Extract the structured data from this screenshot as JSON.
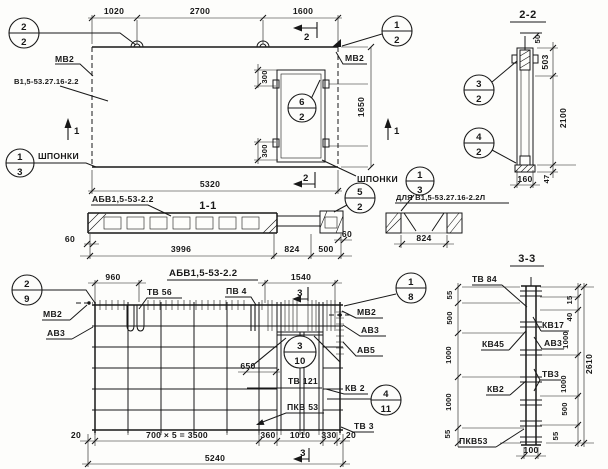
{
  "sheet": {
    "background": "#fdfdfb",
    "ink": "#181818"
  },
  "views": {
    "elevation": {
      "dims": {
        "w1": "1020",
        "w2": "2700",
        "w3": "1600",
        "total": "5320",
        "height": "1650",
        "off_top": "300",
        "off_bottom": "300"
      },
      "labels": {
        "mv2_left": "МВ2",
        "mv2_right": "МВ2",
        "panel_mark": "В1,5-53.27.16-2.2",
        "keys_left": "ШПОНКИ",
        "keys_right": "ШПОНКИ"
      },
      "section_marks": {
        "s1_left": "1",
        "s1_right": "1",
        "s2_top": "2",
        "s2_bottom": "2"
      },
      "callouts": {
        "left": {
          "num": "2",
          "sheet": "2"
        },
        "right": {
          "num": "1",
          "sheet": "2"
        },
        "opening": {
          "num": "6",
          "sheet": "2"
        },
        "keys": {
          "num": "1",
          "sheet": "3"
        }
      }
    },
    "section_2_2": {
      "title": "2-2",
      "dims": {
        "d50": "50",
        "d503": "503",
        "d2100": "2100",
        "d47": "47",
        "d160": "160"
      },
      "callouts": {
        "upper": {
          "num": "3",
          "sheet": "2"
        },
        "lower": {
          "num": "4",
          "sheet": "2"
        }
      }
    },
    "section_1_1": {
      "title": "1-1",
      "mark": "АБВ1,5-53-2.2",
      "dims": {
        "d60l": "60",
        "d3996": "3996",
        "d824": "824",
        "d500": "500",
        "d60r": "60"
      },
      "callout": {
        "num": "5",
        "sheet": "2"
      }
    },
    "detail": {
      "label": "ДЛЯ В1,5-53.27.16-2.2Л",
      "dim": "824",
      "callout": {
        "num": "1",
        "sheet": "3"
      }
    },
    "reinforcement": {
      "title": "АБВ1,5-53-2.2",
      "dims": {
        "d960": "960",
        "d1540": "1540",
        "d650": "650",
        "d20l": "20",
        "row": "700 × 5 = 3500",
        "d360": "360",
        "d1010": "1010",
        "d330": "330",
        "d20r": "20",
        "total": "5240"
      },
      "labels": {
        "tv56": "ТВ 56",
        "pv4": "ПВ 4",
        "mv2_left": "МВ2",
        "av3_left": "АВ3",
        "mv2_right": "МВ2",
        "av3_right": "АВ3",
        "av5": "АВ5",
        "tv121": "ТВ 121",
        "kv2": "КВ 2",
        "pkv53": "ПКВ 53",
        "tv3": "ТВ 3"
      },
      "section_marks": {
        "s3_top": "3",
        "s3_bottom": "3"
      },
      "callouts": {
        "top_left": {
          "num": "2",
          "sheet": "9"
        },
        "top_right": {
          "num": "1",
          "sheet": "8"
        },
        "middle": {
          "num": "3",
          "sheet": "10"
        },
        "bottom_right": {
          "num": "4",
          "sheet": "11"
        }
      }
    },
    "section_3_3": {
      "title": "3-3",
      "labels": {
        "tv84": "ТВ 84",
        "kv17": "КВ17",
        "kv45": "КВ45",
        "av3": "АВ3",
        "kv2": "КВ2",
        "tv3": "ТВ3",
        "pkv53": "ПКВ53"
      },
      "left_dims": [
        "55",
        "500",
        "1000",
        "1000",
        "55"
      ],
      "right_dims": [
        "15",
        "40",
        "1000",
        "1000",
        "500",
        "55"
      ],
      "overall": "2610",
      "bottom": "100"
    }
  }
}
